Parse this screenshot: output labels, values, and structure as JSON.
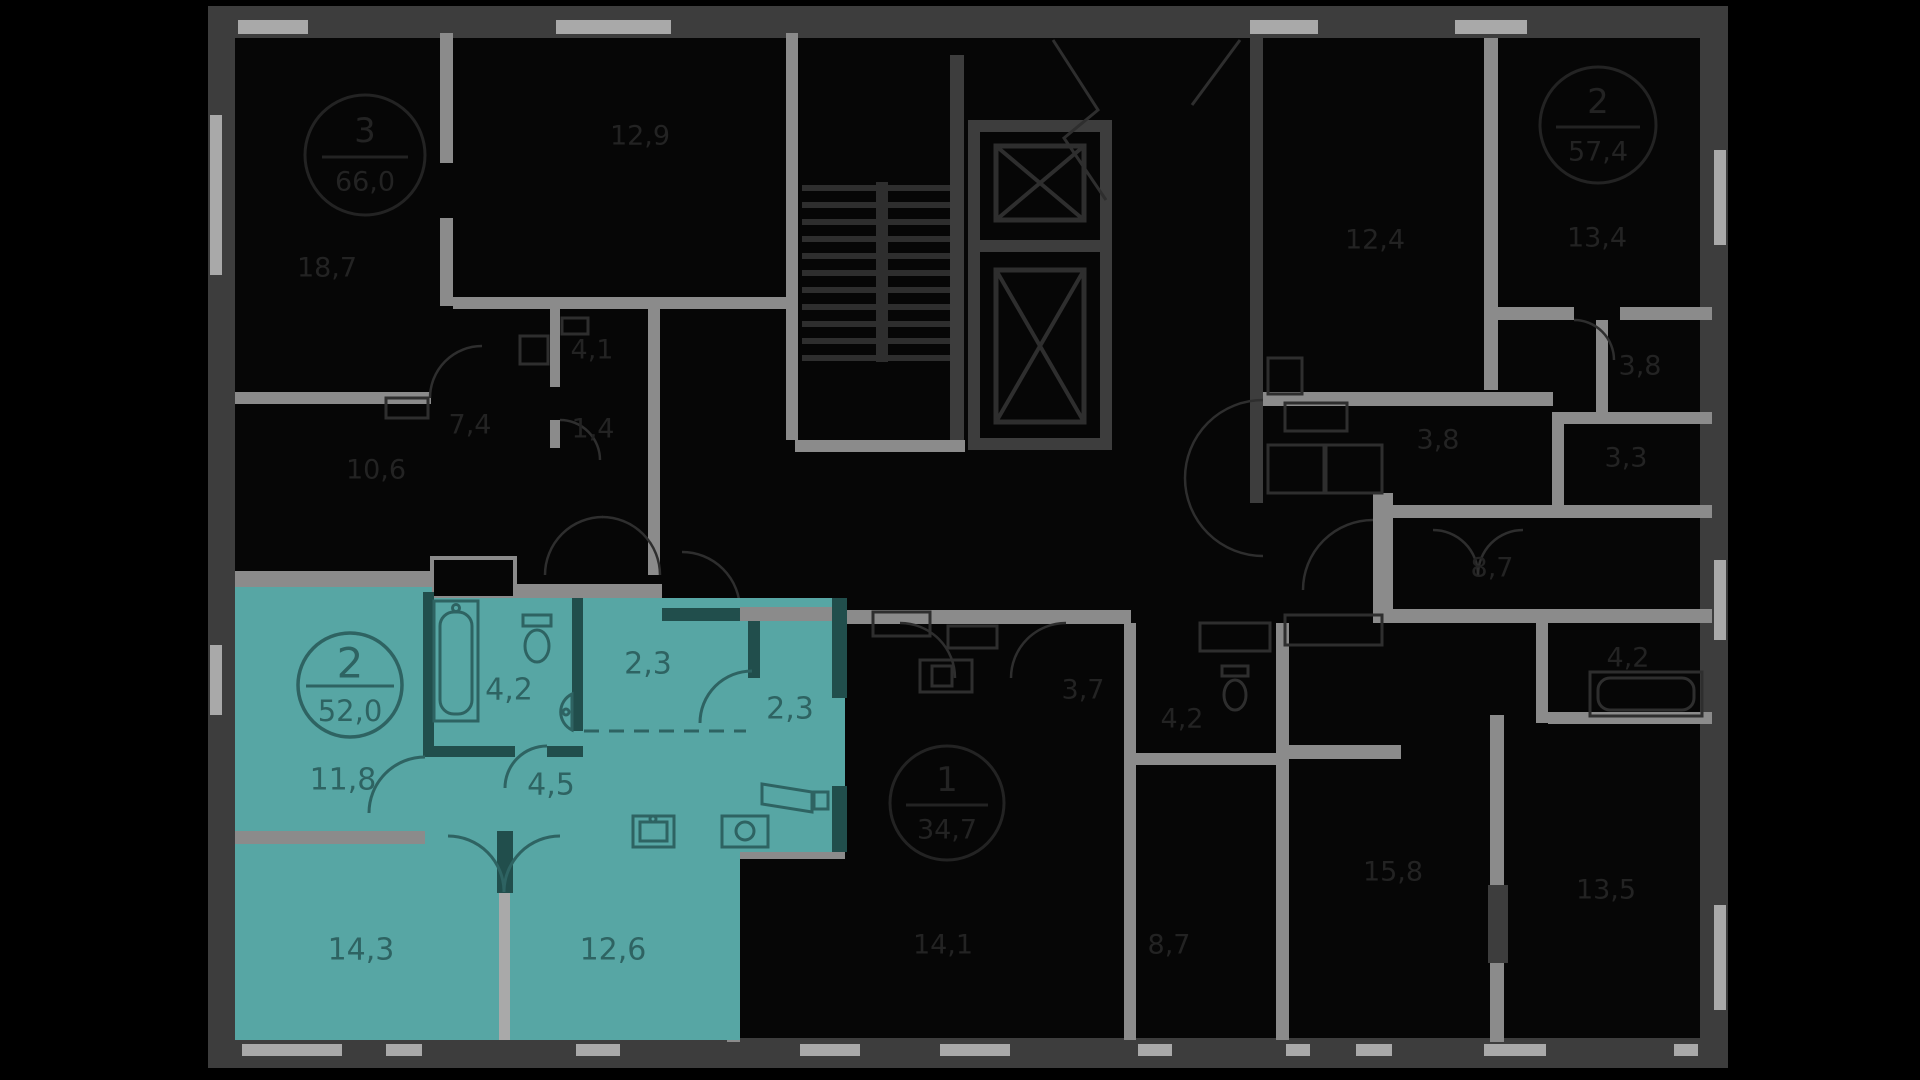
{
  "plan": {
    "selected_apartment": {
      "badge": {
        "rooms": "2",
        "area": "52,0"
      },
      "rooms": {
        "living": "11,8",
        "bathroom": "4,2",
        "hallway_upper": "2,3",
        "wardrobe": "2,3",
        "hallway": "4,5",
        "bedroom": "14,3",
        "kitchen_living": "12,6"
      },
      "highlight_color": "#57A6A4",
      "label_color": "#2E6362"
    },
    "apartment_top_left": {
      "badge": {
        "rooms": "3",
        "area": "66,0"
      },
      "rooms": {
        "living": "18,7",
        "bedroom": "12,9",
        "kitchen": "10,6",
        "hallway": "7,4",
        "bathroom": "4,1",
        "wc": "1,4"
      }
    },
    "apartment_top_right": {
      "badge": {
        "rooms": "2",
        "area": "57,4"
      },
      "rooms": {
        "bedroom_a": "12,4",
        "bedroom_b": "13,4",
        "wardrobe": "3,8",
        "bathroom": "3,8",
        "wc": "3,3",
        "kitchen": "8,7",
        "bathroom_2": "4,2",
        "living_a": "15,8",
        "living_b": "13,5"
      }
    },
    "apartment_bottom_middle": {
      "badge": {
        "rooms": "1",
        "area": "34,7"
      },
      "rooms": {
        "hallway": "3,7",
        "bathroom": "4,2",
        "living": "14,1",
        "kitchen": "8,7"
      }
    },
    "colors": {
      "background": "#000000",
      "plan_background": "#060606",
      "wall_dark": "#3D3D3D",
      "wall_gray": "#8B8B8B",
      "wall_light": "#A9A9A9",
      "dim_text": "#232323"
    }
  }
}
